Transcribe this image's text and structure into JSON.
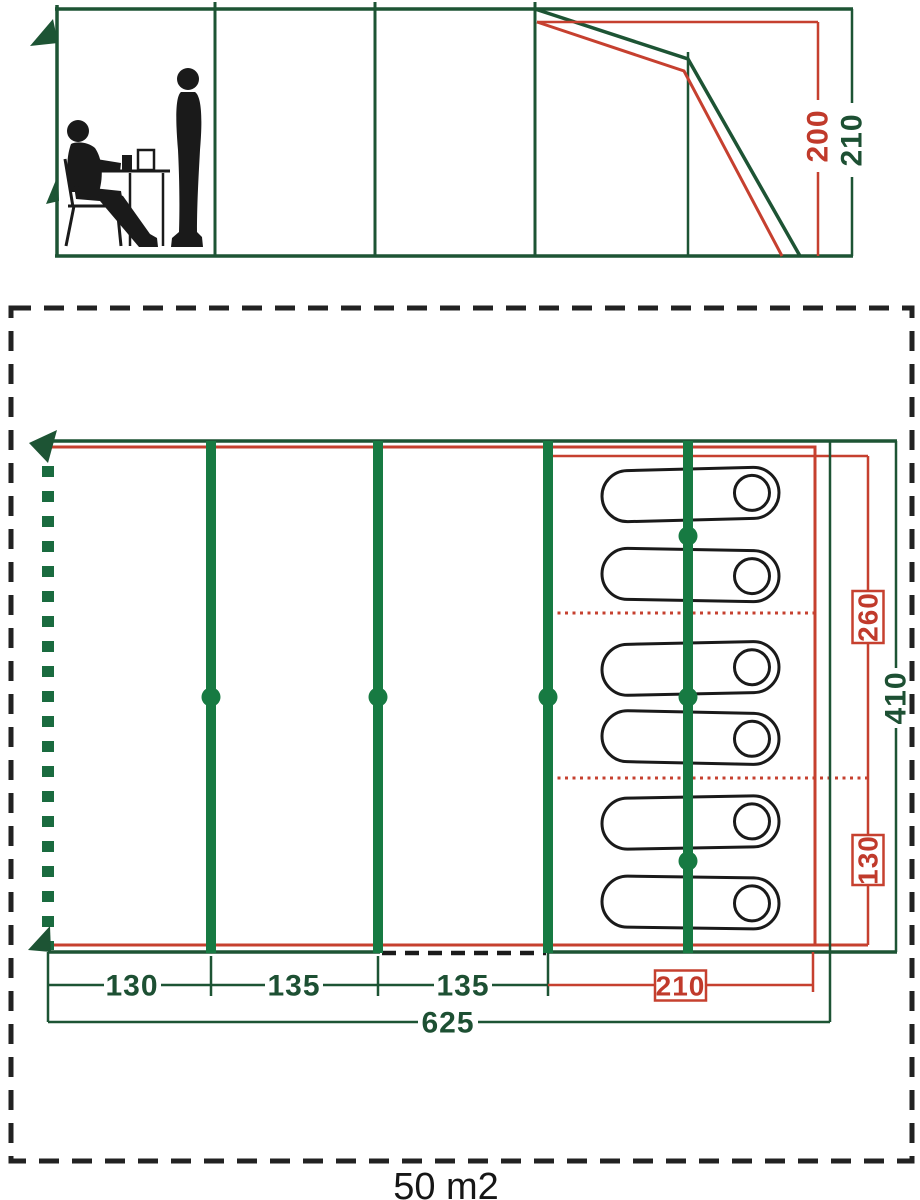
{
  "diagram": "tent-dimension-drawing",
  "colors": {
    "green_line": "#1d5434",
    "green_pole": "#177a42",
    "green_label": "#1d5033",
    "red": "#c6402f",
    "black": "#1a1a1a"
  },
  "elevation": {
    "height_inner": "200",
    "height_outer": "210"
  },
  "floorplan": {
    "right": {
      "bedroom_depth": "260",
      "rear_depth": "130",
      "total_depth": "410"
    },
    "bottom": {
      "section1": "130",
      "section2": "135",
      "section3": "135",
      "bedroom": "210",
      "total": "625"
    },
    "area": "50 m2"
  }
}
